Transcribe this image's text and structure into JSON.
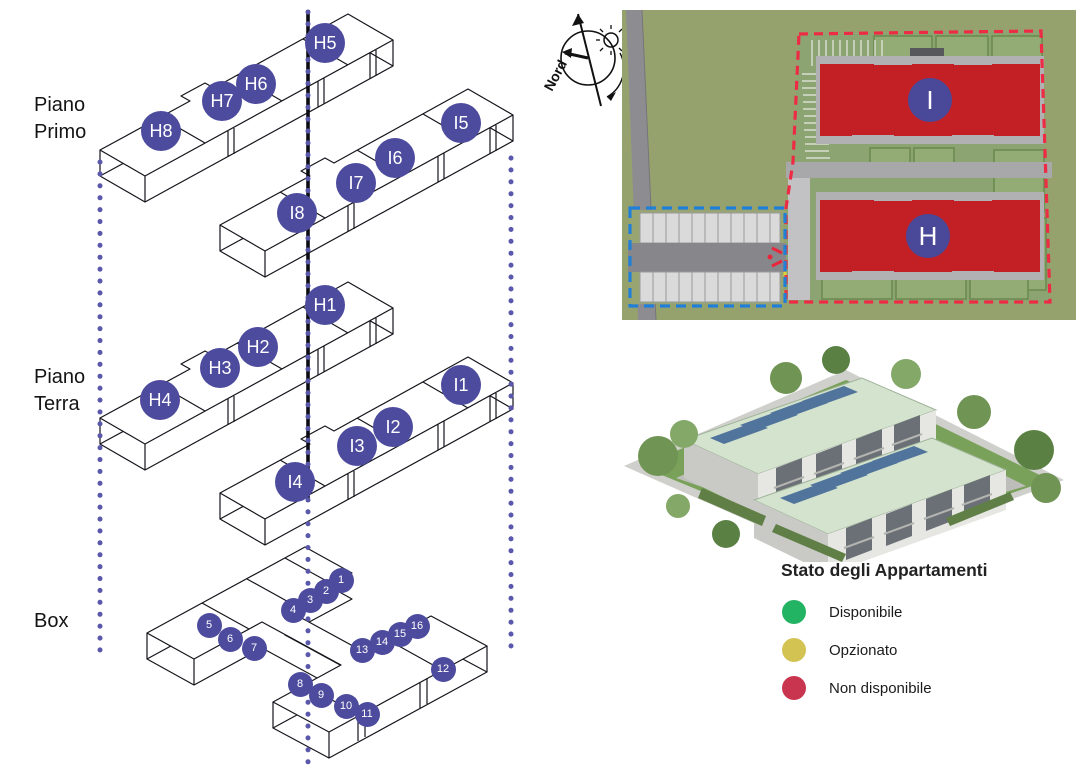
{
  "floors": {
    "primo": {
      "label": "Piano Primo",
      "units": [
        {
          "id": "H5",
          "x": 325,
          "y": 43
        },
        {
          "id": "H6",
          "x": 256,
          "y": 84
        },
        {
          "id": "H7",
          "x": 222,
          "y": 101
        },
        {
          "id": "H8",
          "x": 161,
          "y": 131
        },
        {
          "id": "I5",
          "x": 461,
          "y": 123
        },
        {
          "id": "I6",
          "x": 395,
          "y": 158
        },
        {
          "id": "I7",
          "x": 356,
          "y": 183
        },
        {
          "id": "I8",
          "x": 297,
          "y": 213
        }
      ]
    },
    "terra": {
      "label": "Piano Terra",
      "units": [
        {
          "id": "H1",
          "x": 325,
          "y": 305
        },
        {
          "id": "H2",
          "x": 258,
          "y": 347
        },
        {
          "id": "H3",
          "x": 220,
          "y": 368
        },
        {
          "id": "H4",
          "x": 160,
          "y": 400
        },
        {
          "id": "I1",
          "x": 461,
          "y": 385
        },
        {
          "id": "I2",
          "x": 393,
          "y": 427
        },
        {
          "id": "I3",
          "x": 357,
          "y": 446
        },
        {
          "id": "I4",
          "x": 295,
          "y": 482
        }
      ]
    },
    "box": {
      "label": "Box",
      "units": [
        {
          "id": "1",
          "x": 341,
          "y": 580
        },
        {
          "id": "2",
          "x": 326,
          "y": 591
        },
        {
          "id": "3",
          "x": 310,
          "y": 600
        },
        {
          "id": "4",
          "x": 293,
          "y": 610
        },
        {
          "id": "5",
          "x": 209,
          "y": 625
        },
        {
          "id": "6",
          "x": 230,
          "y": 639
        },
        {
          "id": "7",
          "x": 254,
          "y": 648
        },
        {
          "id": "8",
          "x": 300,
          "y": 684
        },
        {
          "id": "9",
          "x": 321,
          "y": 695
        },
        {
          "id": "10",
          "x": 346,
          "y": 706
        },
        {
          "id": "11",
          "x": 367,
          "y": 714
        },
        {
          "id": "12",
          "x": 443,
          "y": 669
        },
        {
          "id": "13",
          "x": 362,
          "y": 650
        },
        {
          "id": "14",
          "x": 382,
          "y": 642
        },
        {
          "id": "15",
          "x": 400,
          "y": 634
        },
        {
          "id": "16",
          "x": 417,
          "y": 626
        }
      ]
    }
  },
  "compass": {
    "label": "Nord"
  },
  "site_plan": {
    "buildings": [
      {
        "id": "I"
      },
      {
        "id": "H"
      }
    ]
  },
  "legend": {
    "title": "Stato degli Appartamenti",
    "items": [
      {
        "label": "Disponibile",
        "color": "#22b462"
      },
      {
        "label": "Opzionato",
        "color": "#d2c352"
      },
      {
        "label": "Non disponibile",
        "color": "#c9344f"
      }
    ]
  },
  "marker_color": "#4d4b9d"
}
